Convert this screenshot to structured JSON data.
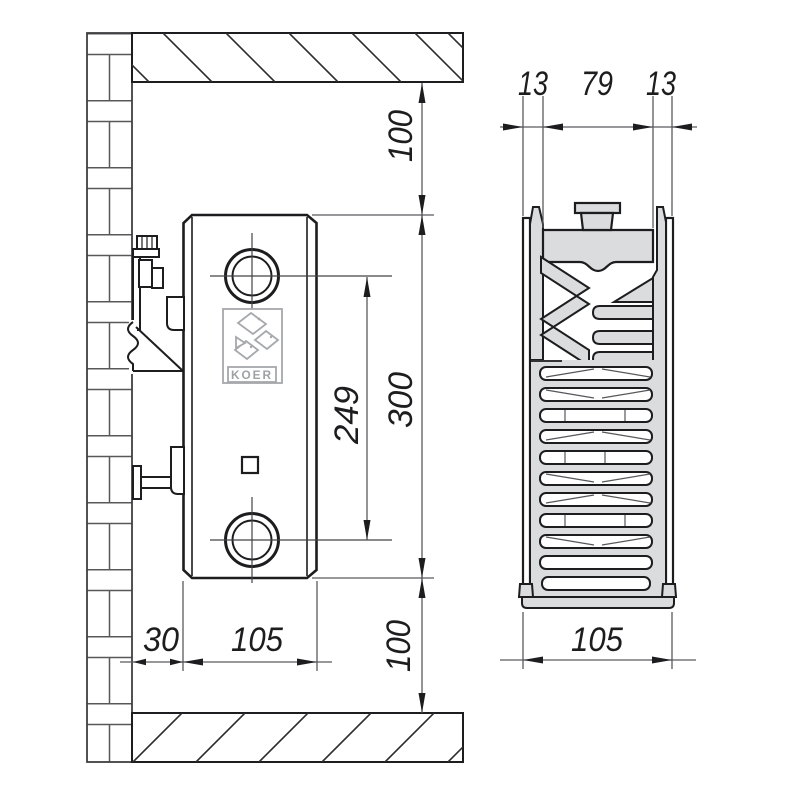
{
  "logo": {
    "text": "KOER"
  },
  "dimensions": {
    "side_view": {
      "ceiling_to_top": "100",
      "height": "300",
      "port_spacing": "249",
      "bottom_to_floor": "100",
      "wall_gap": "30",
      "depth": "105"
    },
    "section_view": {
      "front": "13",
      "middle": "79",
      "back": "13",
      "depth": "105"
    }
  },
  "colors": {
    "line": "#1d1d1f",
    "thin_line": "#5a5b5e",
    "gray_fill": "#dbdcde",
    "logo_gray": "#a6a8ab",
    "background": "#ffffff"
  }
}
